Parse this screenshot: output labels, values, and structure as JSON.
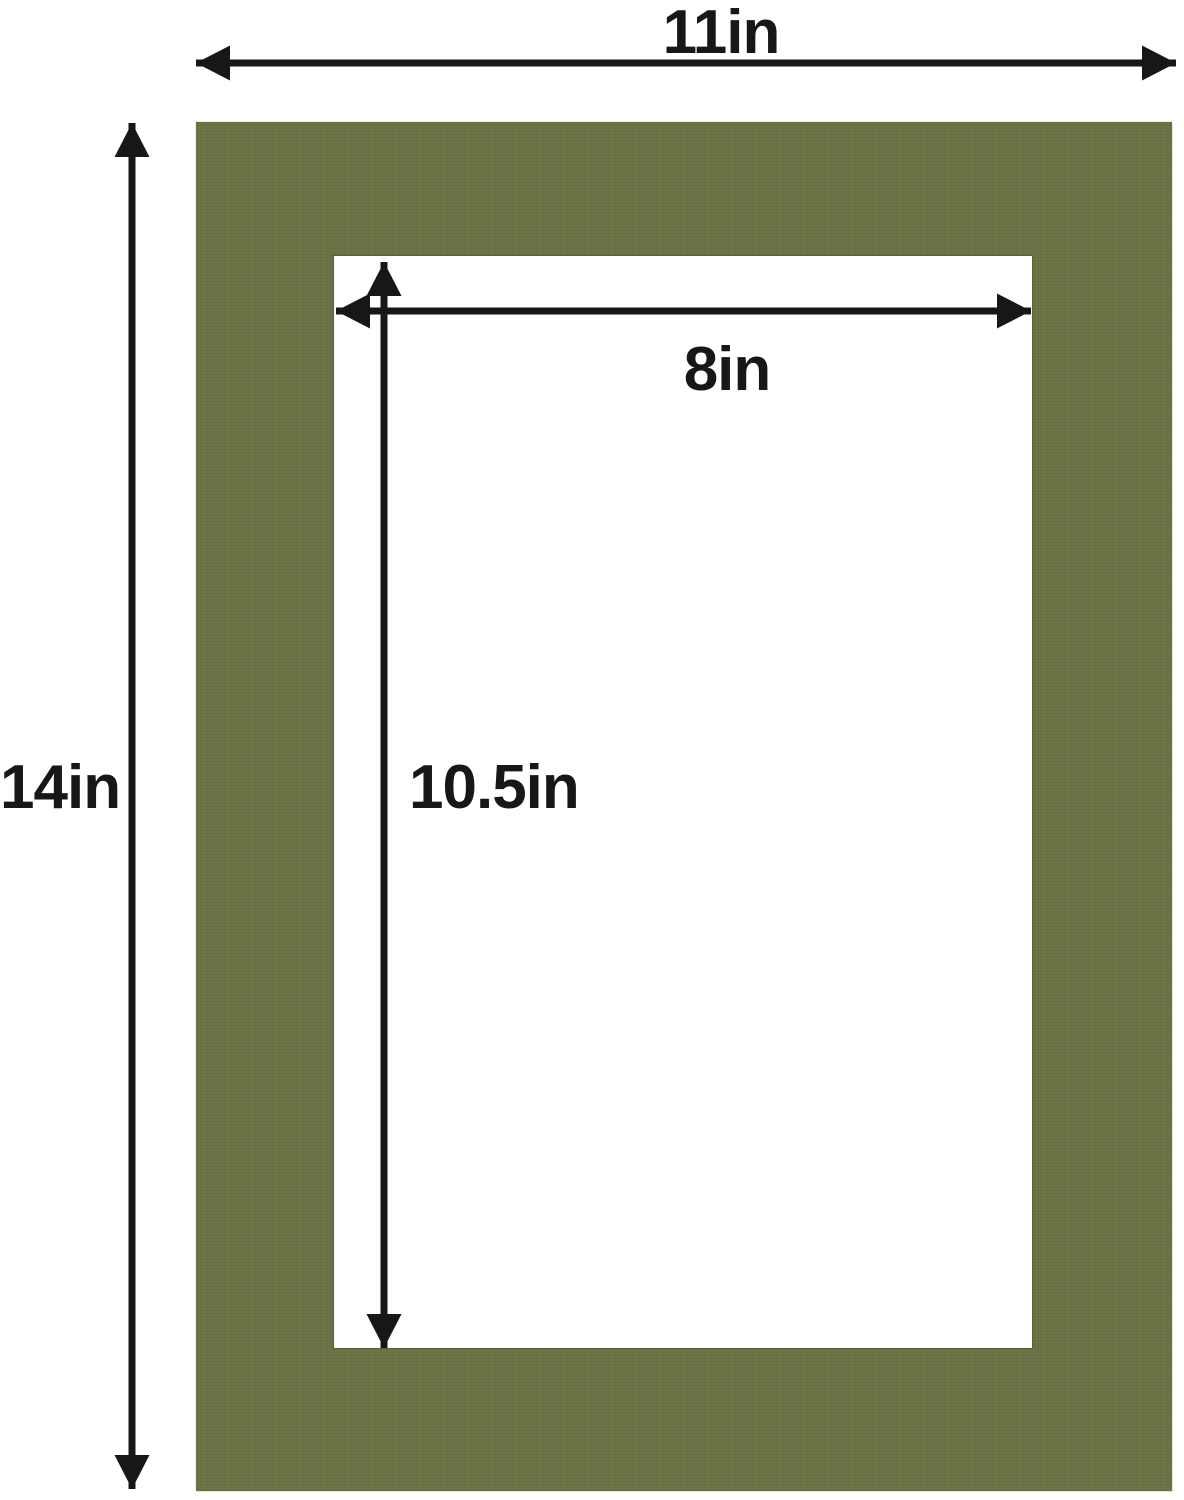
{
  "labels": {
    "outer_width": "11in",
    "outer_height": "14in",
    "opening_width": "8in",
    "opening_height": "10.5in"
  },
  "colors": {
    "mat_green": "#6a7143",
    "arrow_black": "#171717",
    "background": "#ffffff"
  }
}
